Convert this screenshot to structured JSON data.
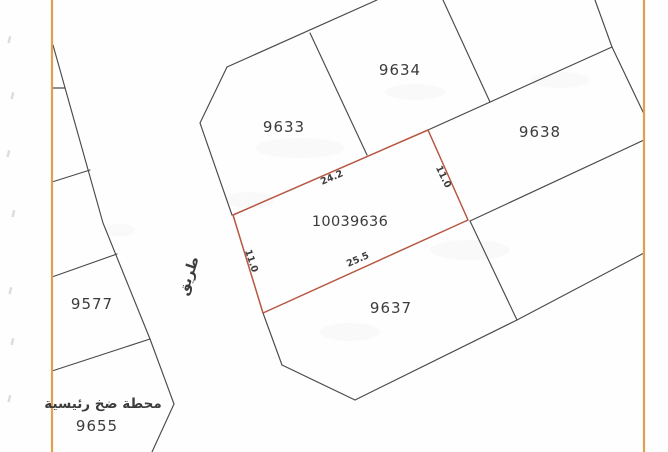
{
  "title": "Cadastral land plot map",
  "map": {
    "width": 668,
    "height": 452,
    "colors": {
      "border": "#dfa24b",
      "line": "#4a4a4a",
      "highlight": "#b65741",
      "text": "#3c3c3c"
    },
    "border_lines": [
      {
        "name": "left-map-border",
        "points": [
          [
            52,
            0
          ],
          [
            52,
            452
          ]
        ]
      },
      {
        "name": "right-map-border",
        "points": [
          [
            644,
            0
          ],
          [
            644,
            452
          ]
        ]
      }
    ],
    "boundary_lines": [
      {
        "name": "road-west-diagonal",
        "points": [
          [
            53,
            45
          ],
          [
            103,
            223
          ],
          [
            150,
            339
          ]
        ]
      },
      {
        "name": "west-strip-divider-1",
        "points": [
          [
            52,
            88
          ],
          [
            65,
            88
          ]
        ]
      },
      {
        "name": "west-strip-divider-2",
        "points": [
          [
            52,
            182
          ],
          [
            90,
            170
          ]
        ]
      },
      {
        "name": "west-strip-divider-3",
        "points": [
          [
            52,
            277
          ],
          [
            117,
            254
          ]
        ]
      },
      {
        "name": "west-strip-divider-4",
        "points": [
          [
            52,
            371
          ],
          [
            150,
            339
          ]
        ]
      },
      {
        "name": "parcel-9655-chevron-edge",
        "points": [
          [
            150,
            339
          ],
          [
            174,
            404
          ],
          [
            152,
            452
          ]
        ]
      },
      {
        "name": "block-northwest-edge",
        "points": [
          [
            227,
            67
          ],
          [
            377,
            0
          ]
        ]
      },
      {
        "name": "parcel-9633-west-edge",
        "points": [
          [
            227,
            67
          ],
          [
            200,
            123
          ],
          [
            232,
            215
          ]
        ]
      },
      {
        "name": "divider-9633-9634",
        "points": [
          [
            310,
            33
          ],
          [
            367,
            155
          ]
        ]
      },
      {
        "name": "parcel-9634-east-edge",
        "points": [
          [
            443,
            0
          ],
          [
            490,
            102
          ]
        ]
      },
      {
        "name": "block-top-street-line",
        "points": [
          [
            428,
            130
          ],
          [
            612,
            47
          ]
        ]
      },
      {
        "name": "northeast-corner-edge",
        "points": [
          [
            595,
            0
          ],
          [
            612,
            47
          ]
        ]
      },
      {
        "name": "parcel-9638-northeast-edge",
        "points": [
          [
            612,
            47
          ],
          [
            644,
            114
          ]
        ]
      },
      {
        "name": "parcel-9638-south-edge",
        "points": [
          [
            470,
            221
          ],
          [
            644,
            140
          ]
        ]
      },
      {
        "name": "divider-9637-east",
        "points": [
          [
            470,
            221
          ],
          [
            517,
            320
          ]
        ]
      },
      {
        "name": "parcel-9637-west-edge",
        "points": [
          [
            263,
            313
          ],
          [
            282,
            365
          ]
        ]
      },
      {
        "name": "parcel-9637-southwest-edge",
        "points": [
          [
            282,
            365
          ],
          [
            355,
            400
          ]
        ]
      },
      {
        "name": "block-south-street-line",
        "points": [
          [
            355,
            400
          ],
          [
            517,
            320
          ],
          [
            644,
            253
          ]
        ]
      }
    ],
    "highlight_parcel": {
      "number": "10039636",
      "label_x": 350,
      "label_y": 222,
      "polygon": [
        [
          233,
          215
        ],
        [
          428,
          130
        ],
        [
          468,
          220
        ],
        [
          263,
          313
        ]
      ],
      "dimensions": [
        {
          "text": "24.2",
          "x": 332,
          "y": 178,
          "angle": -23
        },
        {
          "text": "11.0",
          "x": 443,
          "y": 177,
          "angle": 64
        },
        {
          "text": "25.5",
          "x": 358,
          "y": 260,
          "angle": -24
        },
        {
          "text": "11.0",
          "x": 251,
          "y": 261,
          "angle": 71
        }
      ]
    },
    "parcels": [
      {
        "number": "9633",
        "x": 284,
        "y": 127
      },
      {
        "number": "9634",
        "x": 400,
        "y": 70
      },
      {
        "number": "9638",
        "x": 540,
        "y": 132
      },
      {
        "number": "9637",
        "x": 391,
        "y": 308
      },
      {
        "number": "9577",
        "x": 92,
        "y": 304
      },
      {
        "number": "9655",
        "x": 97,
        "y": 426
      }
    ],
    "annotations": [
      {
        "name": "road-label",
        "text": "طريق",
        "x": 189,
        "y": 276,
        "angle": -72,
        "size": 14,
        "bold": true
      },
      {
        "name": "pump-station-label",
        "text": "محطة ضخ رئيسية",
        "x": 103,
        "y": 404,
        "angle": 0,
        "size": 13.5,
        "bold": true
      }
    ]
  }
}
